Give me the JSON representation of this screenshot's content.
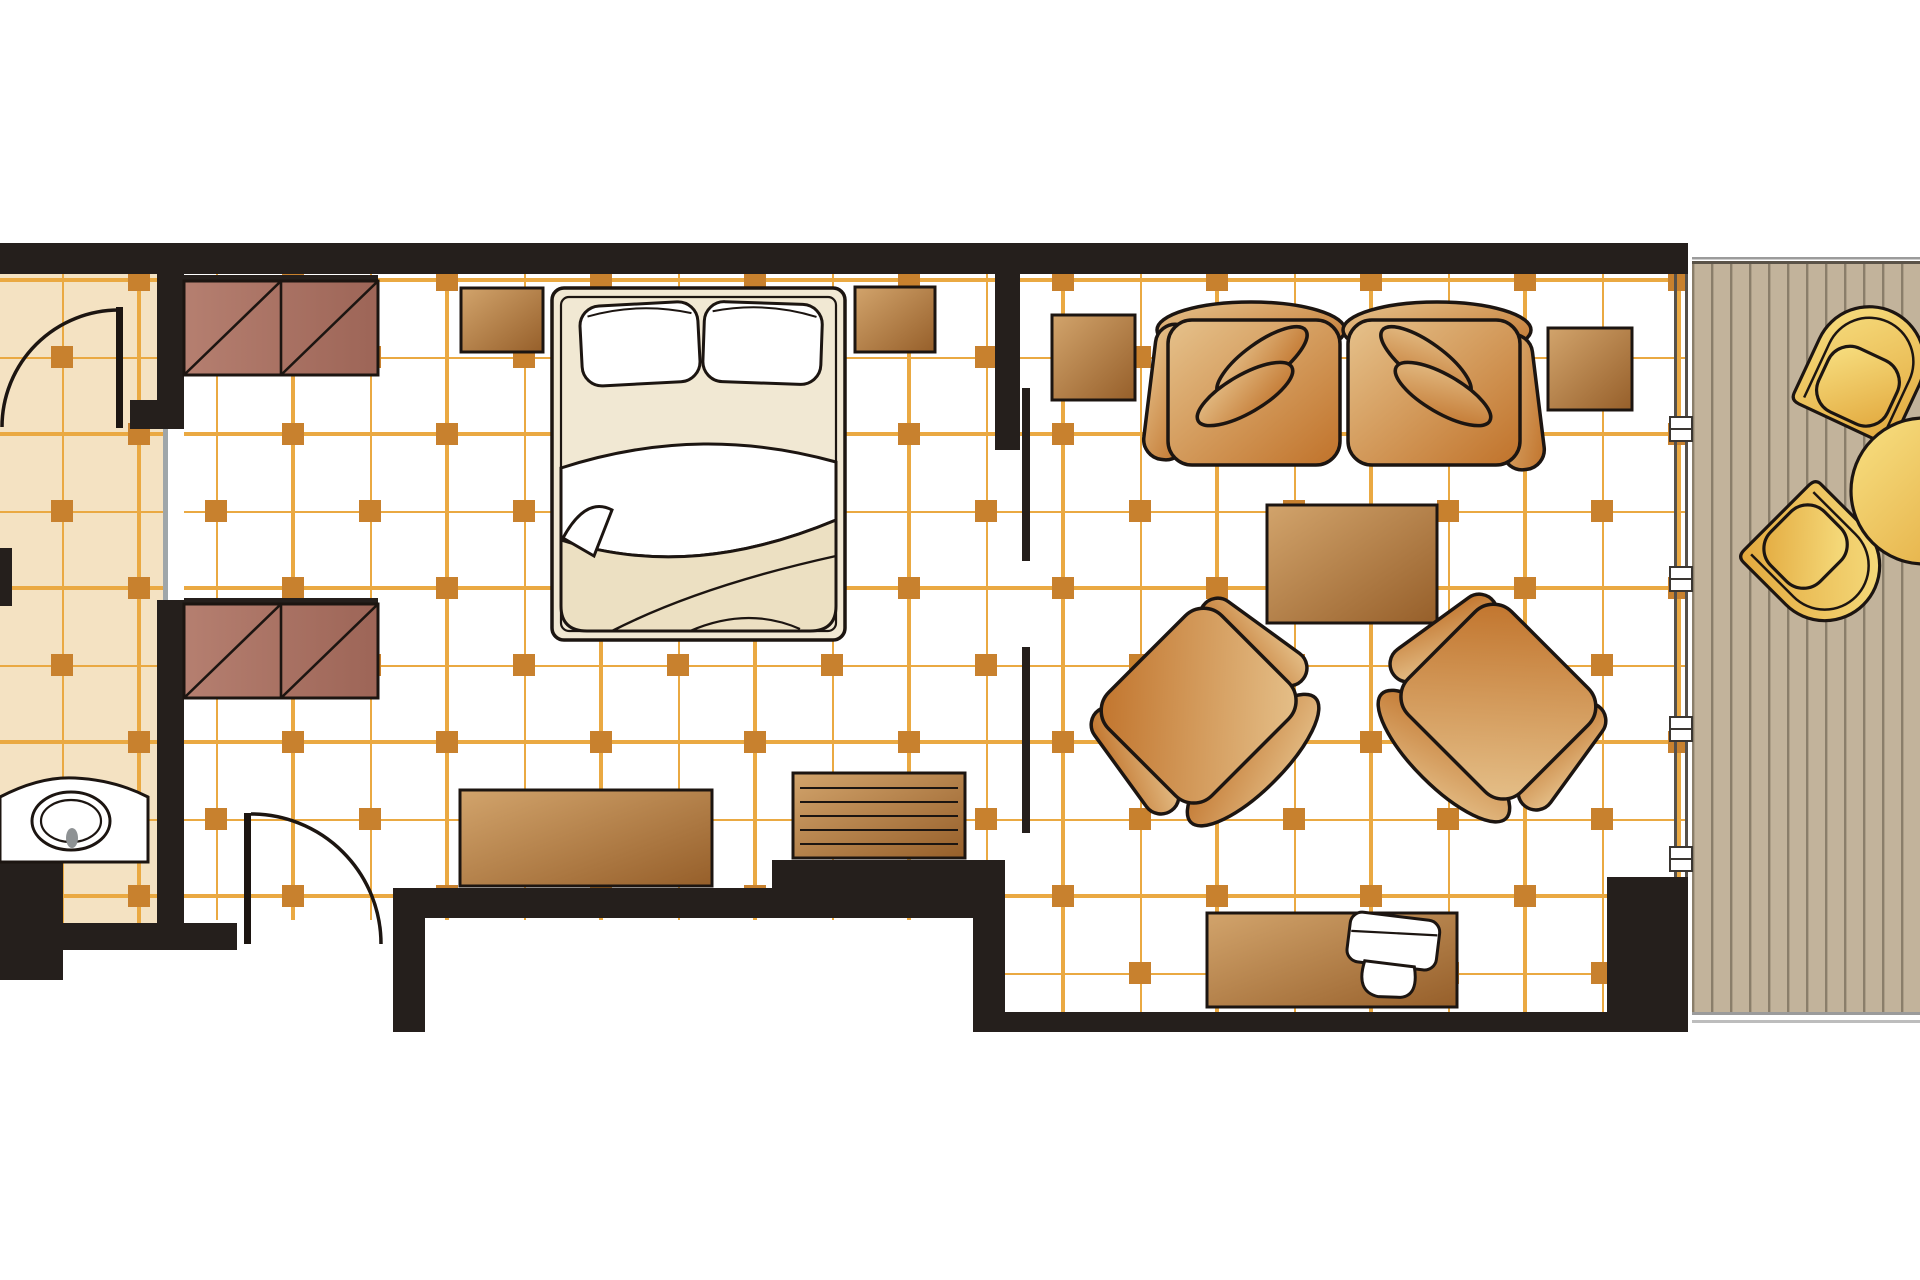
{
  "page": {
    "title": "Hotel Suite Floor Plan",
    "visible_text": []
  },
  "palette": {
    "wall": "#251f1c",
    "outline": "#1c1511",
    "grid_line": "#eaa942",
    "grid_square": "#c8812e",
    "bath_floor": "#f4e2c2",
    "room_floor": "#ffffff",
    "furn_light": "#d2a46c",
    "furn_dark": "#965f2a",
    "wardrobe_light": "#b57f70",
    "wardrobe_dark": "#9d6557",
    "sofa_light": "#e6c28c",
    "sofa_dark": "#c0722a",
    "bed_frame": "#f1e8d3",
    "duvet": "#ece0c2",
    "deck": "#c2b39b",
    "deck_line": "#8a7e6a",
    "chair_light": "#f8e183",
    "chair_dark": "#e2a83d",
    "glass": "#9fa6a9",
    "grey_line": "#9b9b9b",
    "frame_line": "#55504a"
  },
  "floor_plan": {
    "rooms": [
      {
        "name": "bathroom",
        "floor": "beige tile grid",
        "features": [
          "vanity-with-oval-sink",
          "swing-door"
        ]
      },
      {
        "name": "bedroom",
        "floor": "white tile grid",
        "features": [
          "wardrobe-x2",
          "double-bed",
          "nightstand-x2",
          "dresser",
          "luggage-bench",
          "entry-door"
        ]
      },
      {
        "name": "living-room",
        "floor": "white tile grid",
        "features": [
          "two-seat-sofa",
          "armchair-x2",
          "coffee-table",
          "side-table-x2",
          "tv-console",
          "tv",
          "sliding-door"
        ]
      },
      {
        "name": "balcony",
        "floor": "wood deck planks",
        "features": [
          "deck-chair-x2",
          "round-table",
          "glazed-window-wall"
        ]
      }
    ],
    "furniture_counts": {
      "wardrobe": 2,
      "nightstand": 2,
      "bed": 1,
      "dresser": 1,
      "luggage_bench": 1,
      "sofa_seats": 2,
      "sofa_pillows": 4,
      "armchair": 2,
      "coffee_table": 1,
      "side_table": 2,
      "tv_console": 1,
      "tv": 1,
      "sink": 1,
      "balcony_chair": 2,
      "balcony_table": 1
    },
    "doors": [
      "bathroom-swing-door",
      "entry-swing-door",
      "bedroom-living-sliding-door"
    ],
    "windows": [
      "balcony-glazed-wall-with-mullions"
    ]
  }
}
